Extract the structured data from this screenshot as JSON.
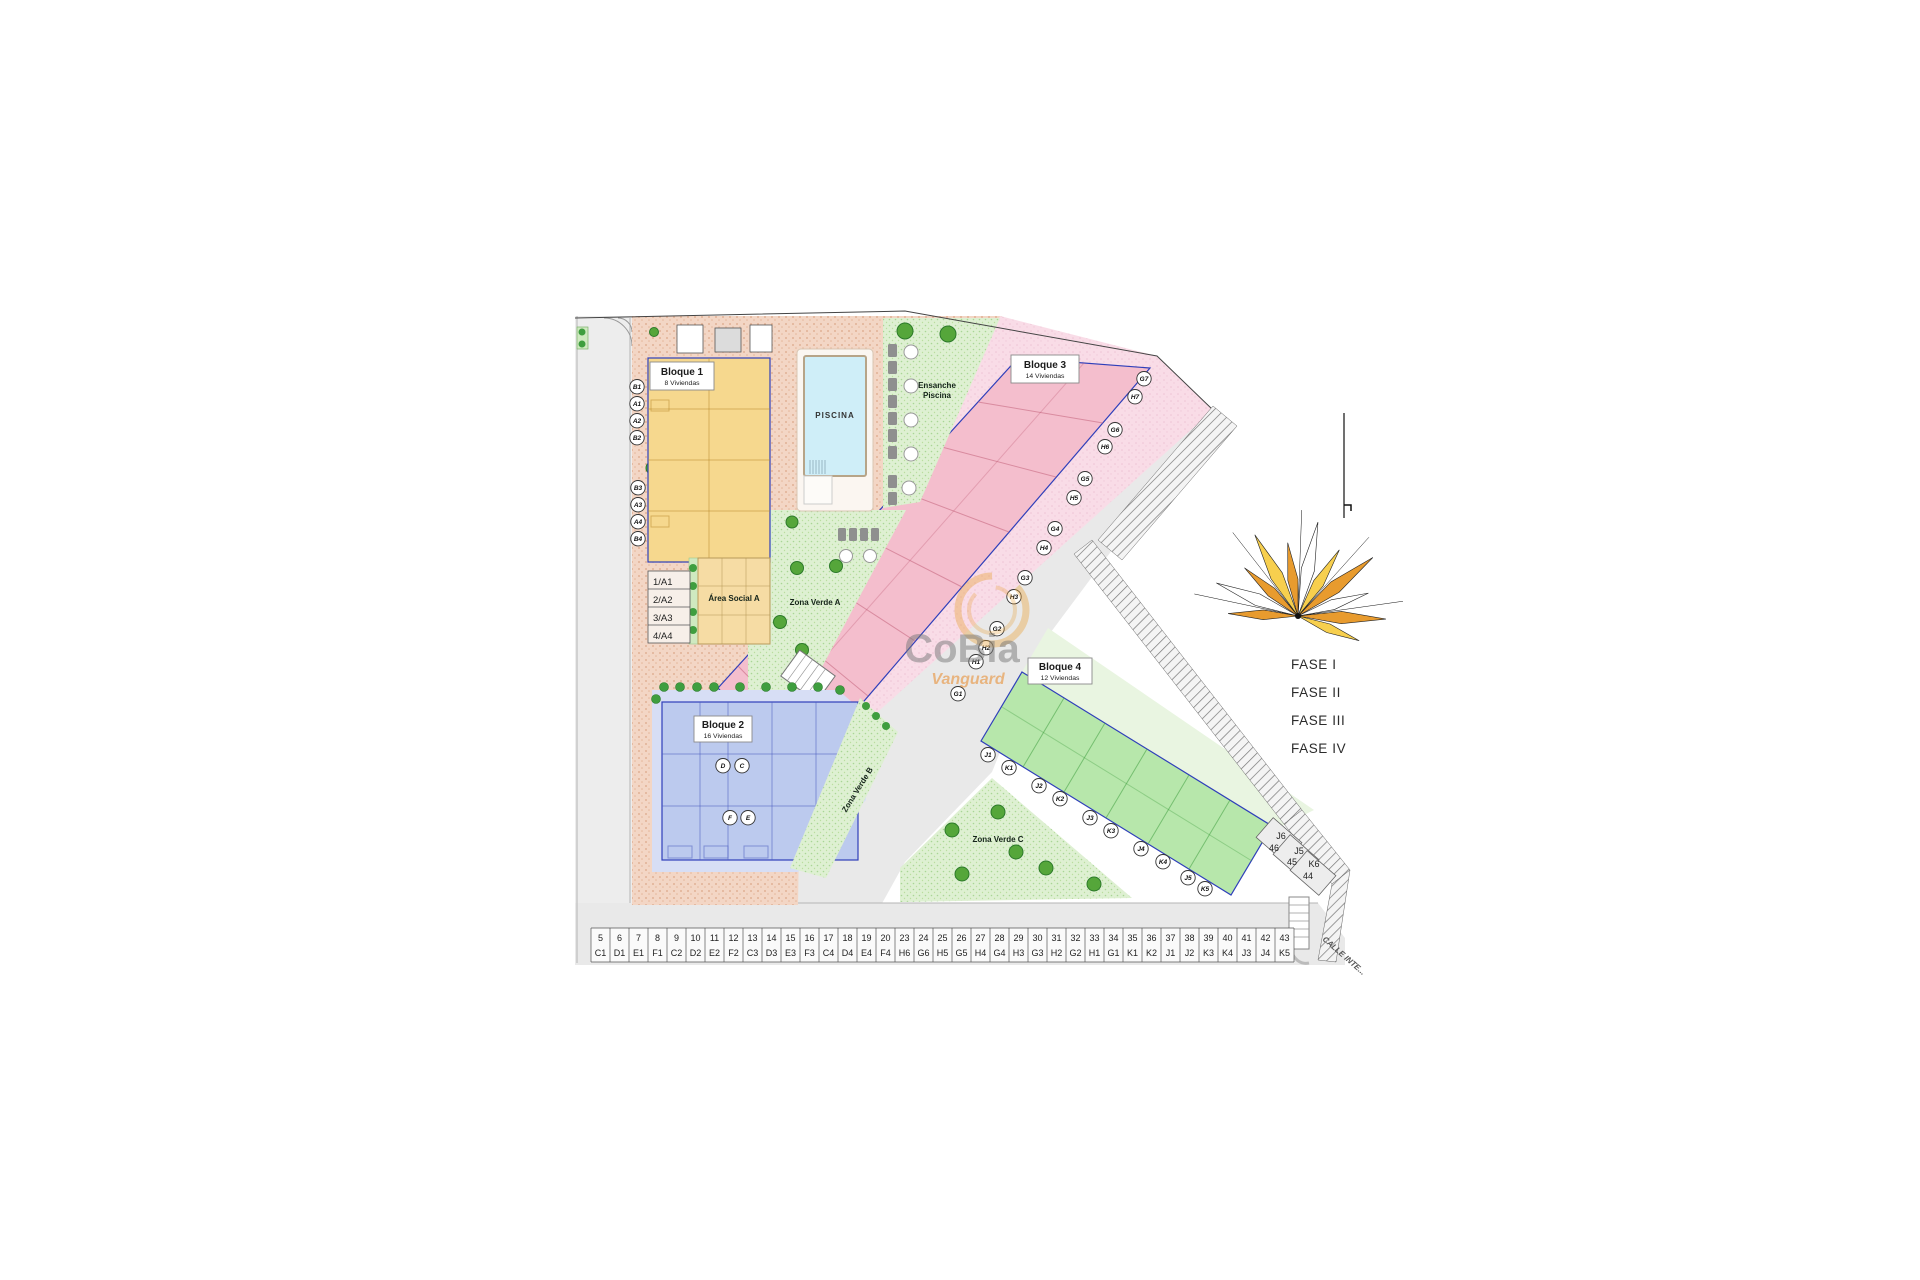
{
  "blocks": {
    "bloque1": {
      "name": "Bloque 1",
      "units": "8 Viviendas",
      "circles": [
        "B1",
        "A1",
        "A2",
        "B2",
        "B3",
        "A3",
        "A4",
        "B4"
      ]
    },
    "bloque2": {
      "name": "Bloque 2",
      "units": "16 Viviendas",
      "circles": [
        "D",
        "C",
        "F",
        "E"
      ]
    },
    "bloque3": {
      "name": "Bloque 3",
      "units": "14 Viviendas",
      "circles": [
        "G7",
        "H7",
        "G6",
        "H6",
        "G5",
        "H5",
        "G4",
        "H4",
        "G3",
        "H3",
        "G2",
        "H2",
        "H1",
        "G1"
      ]
    },
    "bloque4": {
      "name": "Bloque 4",
      "units": "12 Viviendas",
      "circles": [
        "J1",
        "K1",
        "J2",
        "K2",
        "J3",
        "K3",
        "J4",
        "K4",
        "J5",
        "K5"
      ]
    }
  },
  "areas": {
    "piscina": "PISCINA",
    "ensanche_line1": "Ensanche",
    "ensanche_line2": "Piscina",
    "area_social": "Área Social A",
    "zona_verde_a": "Zona Verde A",
    "zona_verde_b": "Zona Verde B",
    "zona_verde_c": "Zona Verde C"
  },
  "unit_table": [
    "1/A1",
    "2/A2",
    "3/A3",
    "4/A4"
  ],
  "parking_row": [
    {
      "num": "5",
      "code": "C1"
    },
    {
      "num": "6",
      "code": "D1"
    },
    {
      "num": "7",
      "code": "E1"
    },
    {
      "num": "8",
      "code": "F1"
    },
    {
      "num": "9",
      "code": "C2"
    },
    {
      "num": "10",
      "code": "D2"
    },
    {
      "num": "11",
      "code": "E2"
    },
    {
      "num": "12",
      "code": "F2"
    },
    {
      "num": "13",
      "code": "C3"
    },
    {
      "num": "14",
      "code": "D3"
    },
    {
      "num": "15",
      "code": "E3"
    },
    {
      "num": "16",
      "code": "F3"
    },
    {
      "num": "17",
      "code": "C4"
    },
    {
      "num": "18",
      "code": "D4"
    },
    {
      "num": "19",
      "code": "E4"
    },
    {
      "num": "20",
      "code": "F4"
    },
    {
      "num": "23",
      "code": "H6"
    },
    {
      "num": "24",
      "code": "G6"
    },
    {
      "num": "25",
      "code": "H5"
    },
    {
      "num": "26",
      "code": "G5"
    },
    {
      "num": "27",
      "code": "H4"
    },
    {
      "num": "28",
      "code": "G4"
    },
    {
      "num": "29",
      "code": "H3"
    },
    {
      "num": "30",
      "code": "G3"
    },
    {
      "num": "31",
      "code": "H2"
    },
    {
      "num": "32",
      "code": "G2"
    },
    {
      "num": "33",
      "code": "H1"
    },
    {
      "num": "34",
      "code": "G1"
    },
    {
      "num": "35",
      "code": "K1"
    },
    {
      "num": "36",
      "code": "K2"
    },
    {
      "num": "37",
      "code": "J1"
    },
    {
      "num": "38",
      "code": "J2"
    },
    {
      "num": "39",
      "code": "K3"
    },
    {
      "num": "40",
      "code": "K4"
    },
    {
      "num": "41",
      "code": "J3"
    },
    {
      "num": "42",
      "code": "J4"
    },
    {
      "num": "43",
      "code": "K5"
    }
  ],
  "corner_parking": [
    {
      "unit": "J6",
      "num": "46"
    },
    {
      "unit": "J5",
      "num": "45"
    },
    {
      "unit": "K6",
      "num": "44"
    }
  ],
  "street_label": "CALLE INTE...",
  "phases": [
    "FASE I",
    "FASE II",
    "FASE III",
    "FASE IV"
  ],
  "watermark": {
    "line1": "CoBia",
    "line2": "Vanguard"
  },
  "colors": {
    "paving_tan": "#f3d6c5",
    "block1_yellow": "#f6d88e",
    "block2_blue": "#bccaee",
    "block2_zone": "#d7def5",
    "block3_pink": "#f4becd",
    "block3_zone": "#f9dce7",
    "block4_green": "#b7e7ab",
    "block4_zone": "#e9f5e1",
    "green_zone": "#def0d2",
    "road_gray": "#e9e9e9",
    "pool_water": "#cfeef8",
    "plot_border_blue": "#2f3fba",
    "fan_orange": "#e89b2e",
    "fan_yellow": "#f7cf4e",
    "watermark_orange": "#e8a33d"
  }
}
